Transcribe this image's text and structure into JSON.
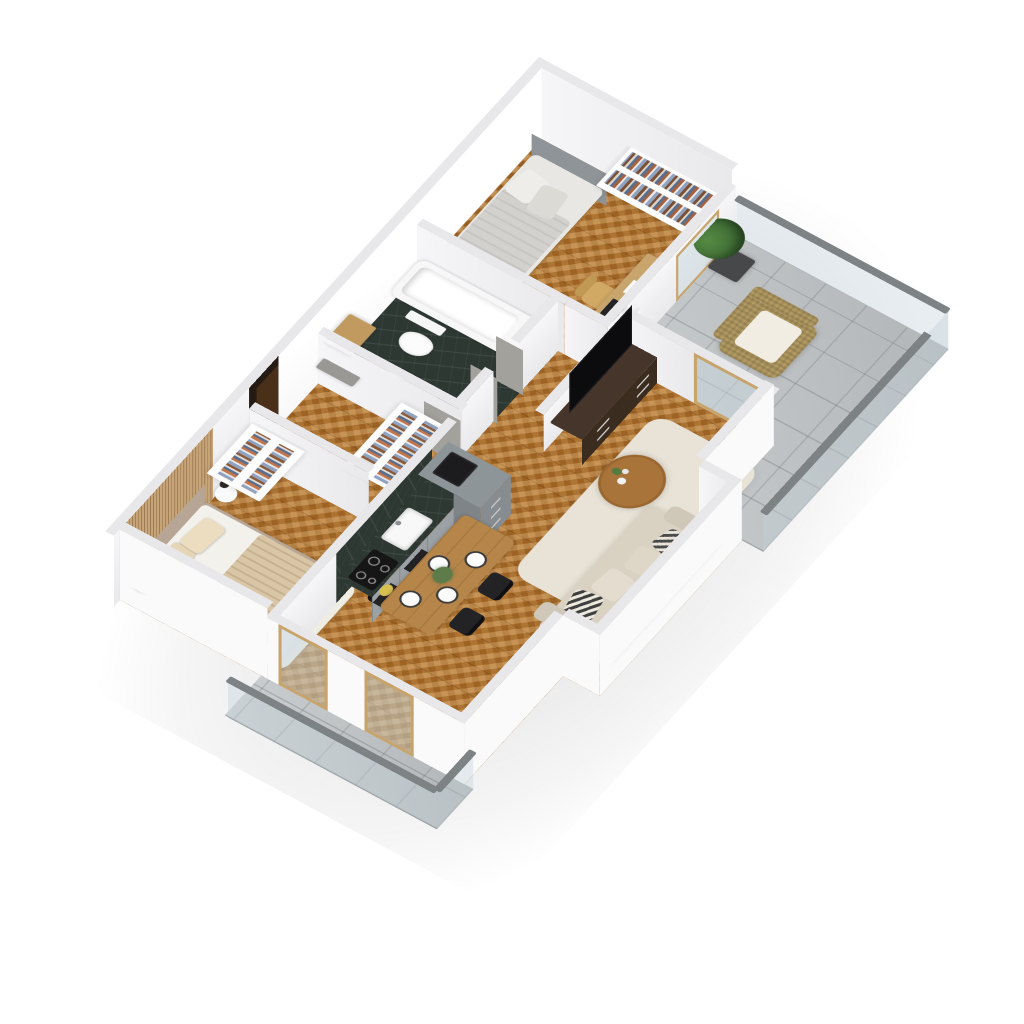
{
  "scene": {
    "kind": "3d-isometric-apartment-floor-plan-render",
    "background": "#ffffff",
    "floorplan_style": "birds-eye cutaway with low walls",
    "no_visible_text": true
  },
  "palette": {
    "floor_wood": "#b5772f",
    "floor_tile": "#bdc1c3",
    "floor_marble": "#2d3833",
    "wall_inner": "#f0f0f3",
    "wall_outer": "#fafafb",
    "wall_top": "#e8e8eb",
    "accent_slats": "#c7a478",
    "entry_wall": "#241b15",
    "entry_door": "#4a3019",
    "glass_door_frame": "#c8a36a",
    "glass": "rgba(195,210,218,0.4)",
    "rail": "#7d8285",
    "bed_frame": "#b7a695",
    "bed_blanket": "#d9c6a6",
    "sofa": "#d9d2c3",
    "rug": "#e9e3d7",
    "tv_console": "#46352a",
    "dining_table": "#b5854a",
    "desk": "#c7a56c",
    "chair_black": "#232325",
    "wicker": "#b29a62",
    "cushion": "#f1ede2",
    "plant": "#3d6a33",
    "counter_cabinet": "#9ba1a5",
    "vanity_wood": "#b98e55",
    "headboard_gray": "#8f9498",
    "stub_gray": "#a3a19c"
  },
  "rooms": [
    {
      "name": "master-bedroom",
      "furniture": [
        "double-bed",
        "upholstered-headboard",
        "white-and-beige-pillows",
        "beige-blanket",
        "round-nightstand-left",
        "round-nightstand-right",
        "black-table-lamps",
        "white-area-rug",
        "open-wardrobe-with-clothes",
        "wood-slat-accent-wall",
        "balcony-doors"
      ]
    },
    {
      "name": "entry-hall",
      "furniture": [
        "dark-entrance-wall",
        "walnut-entrance-door",
        "silver-door-handle",
        "open-hall-wardrobe-with-clothes",
        "gray-fabric-bench"
      ]
    },
    {
      "name": "bathroom",
      "furniture": [
        "wood-vanity",
        "round-white-basin",
        "wood-cabinet",
        "wall-hung-toilet",
        "bathtub",
        "dark-marble-shower-wall",
        "shower-fixture",
        "green-marble-floor"
      ]
    },
    {
      "name": "kitchen",
      "furniture": [
        "l-shaped-counter",
        "dark-marble-countertop",
        "marble-backsplash",
        "white-sink",
        "faucet",
        "induction-cooktop",
        "tall-corner-unit",
        "black-appliance",
        "fruit-bowl"
      ]
    },
    {
      "name": "dining-area",
      "furniture": [
        "oak-dining-table",
        "black-chairs-x4",
        "white-plates-x4",
        "dark-placemats",
        "green-plant-centerpiece"
      ]
    },
    {
      "name": "living-room",
      "furniture": [
        "beige-corner-sofa",
        "striped-pillows",
        "round-wood-coffee-table",
        "vase",
        "cream-shag-rug",
        "dark-tv-console",
        "flat-screen-tv",
        "low-partition-wall",
        "balcony-door"
      ]
    },
    {
      "name": "bedroom-2",
      "furniture": [
        "single-bed",
        "gray-headboard",
        "gray-white-bedding",
        "wall-bookshelves",
        "books",
        "desk",
        "wood-chair",
        "open-wardrobe-with-clothes",
        "balcony-window"
      ]
    },
    {
      "name": "balcony-east",
      "furniture": [
        "wicker-armchair",
        "white-cushions",
        "potted-plant",
        "glass-railing",
        "concrete-tile-floor",
        "wood-framed-doors"
      ]
    },
    {
      "name": "balcony-west",
      "furniture": [
        "glass-railing",
        "concrete-tile-floor",
        "wood-framed-doors"
      ]
    }
  ]
}
